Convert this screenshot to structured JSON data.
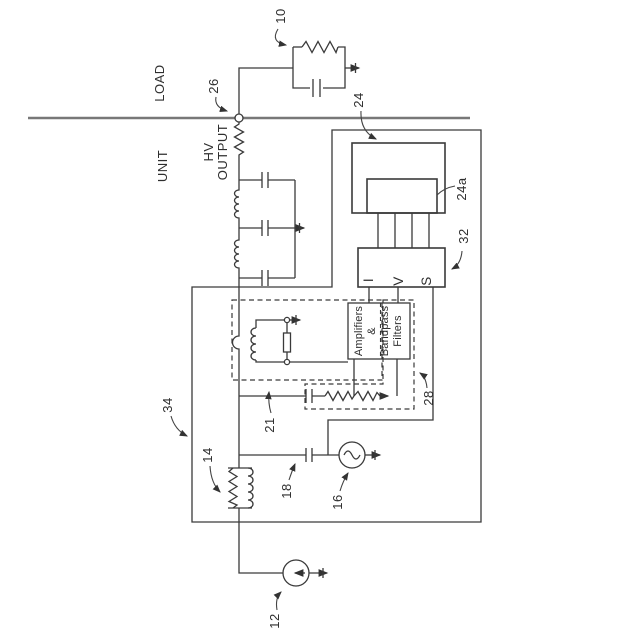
{
  "figure": {
    "type": "patent-circuit-schematic",
    "background": "#ffffff",
    "line_color": "#3a3a3a",
    "boundary_line_color": "#787878",
    "leader_color": "#444444"
  },
  "section_labels": {
    "load": "LOAD",
    "unit": "UNIT",
    "hv_output_line1": "HV",
    "hv_output_line2": "OUTPUT"
  },
  "reference_numerals": {
    "ref10": "10",
    "ref12": "12",
    "ref14": "14",
    "ref16": "16",
    "ref18": "18",
    "ref21": "21",
    "ref24": "24",
    "ref24a": "24a",
    "ref26": "26",
    "ref28": "28",
    "ref32": "32",
    "ref34": "34"
  },
  "monitor_box": {
    "terminal_i": "I",
    "terminal_v": "V",
    "terminal_s": "S"
  },
  "amplifier_filter_box": {
    "line1": "Amplifiers",
    "line2": "&",
    "line3": "Bandpass",
    "line4": "Filters"
  }
}
